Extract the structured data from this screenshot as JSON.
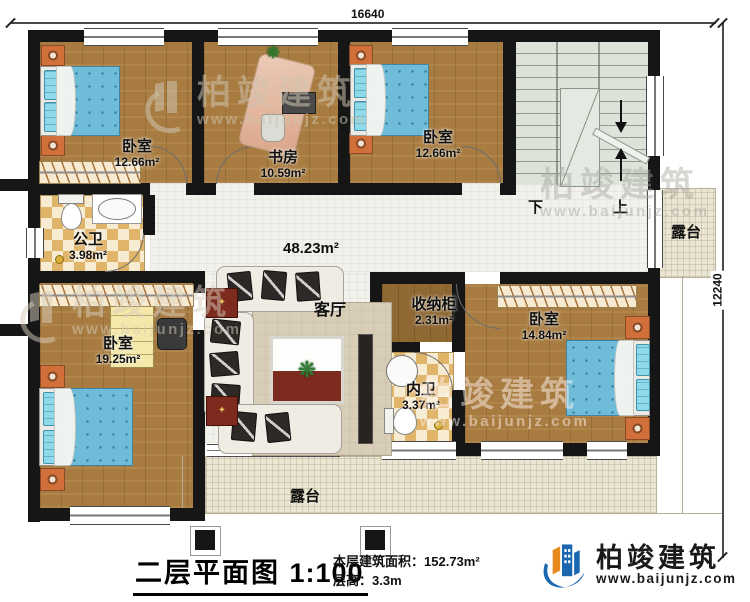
{
  "dimensions": {
    "width_top": "16640",
    "height_right": "12240"
  },
  "rooms": {
    "bedroom_top_left": {
      "name": "卧室",
      "area": "12.66m²"
    },
    "study": {
      "name": "书房",
      "area": "10.59m²"
    },
    "bedroom_top_right": {
      "name": "卧室",
      "area": "12.66m²"
    },
    "public_bathroom": {
      "name": "公卫",
      "area": "3.98m²"
    },
    "living_room": {
      "name": "客厅",
      "hall_area": "48.23m²"
    },
    "storage_cabinet": {
      "name": "收纳柜",
      "area": "2.31m²"
    },
    "bedroom_right": {
      "name": "卧室",
      "area": "14.84m²"
    },
    "inner_bathroom": {
      "name": "内卫",
      "area": "3.37m²"
    },
    "bedroom_bottom_left": {
      "name": "卧室",
      "area": "19.25m²"
    },
    "terrace_right": {
      "name": "露台"
    },
    "terrace_bottom": {
      "name": "露台"
    }
  },
  "stairs": {
    "down_label": "下",
    "up_label": "上"
  },
  "title_block": {
    "plan_title": "二层平面图",
    "scale": "1:100",
    "floor_area_label": "本层建筑面积：",
    "floor_area_value": "152.73m²",
    "floor_height_label": "层高：",
    "floor_height_value": "3.3m"
  },
  "brand": {
    "company": "柏竣建筑",
    "website": "www.baijunjz.com"
  },
  "watermark": {
    "company": "柏竣建筑",
    "website": "www.baijunjz.com"
  },
  "colors": {
    "wall": "#161616",
    "wood_floor": "#a87c41",
    "tile_floor": "#f2f1ec",
    "stair_floor": "#dde3d9",
    "bath_tile": "#e0b469",
    "terrace": "#ebe6d3",
    "bed_blue": "#6fbcd8",
    "accent_orange": "#d2703b",
    "logo_blue": "#1a66b0",
    "logo_orange": "#e8891d"
  }
}
